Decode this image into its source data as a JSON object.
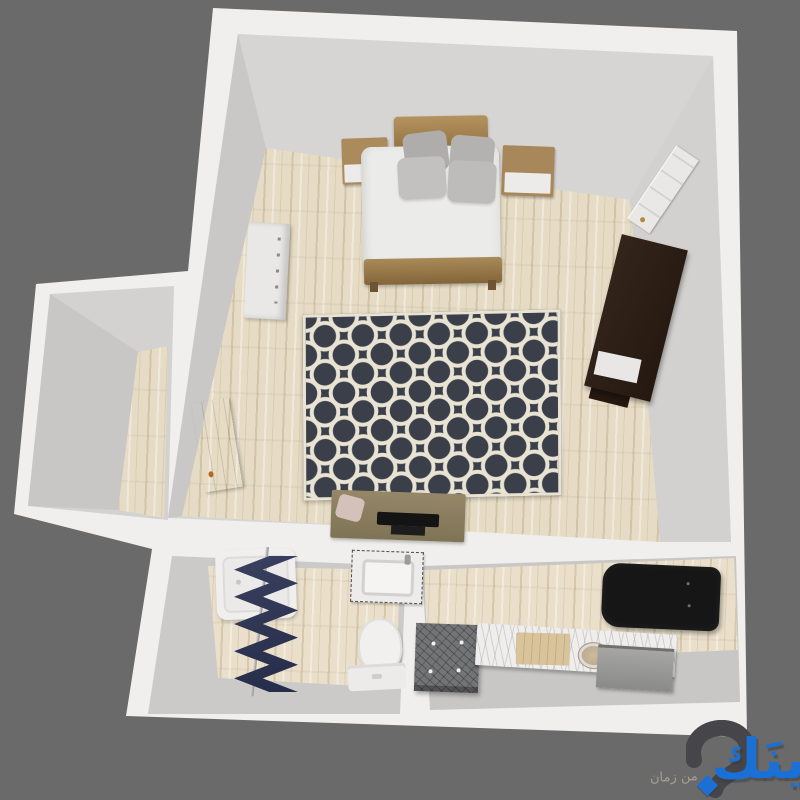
{
  "watermark": {
    "brand_text": "وينَك",
    "tagline_text": "من زمان",
    "brand_color": "#1b70d6",
    "icon": "question-swoosh-icon"
  },
  "palette": {
    "background": "#6a6a6a",
    "wall": "#f0efed",
    "wall_face_light": "#d6d5d3",
    "wall_face_dark": "#c9c8c6",
    "floor_wood": "#e6dcc5",
    "rug_base": "#3a3f49",
    "rug_pattern": "#e9e3d4",
    "curtain_navy": "#343b58",
    "bed_wood": "#a8885a",
    "wardrobe_brown": "#2b1d15",
    "sofa_black": "#161616",
    "marble": "#efeeec",
    "accent_blue": "#1b70d6"
  },
  "plan": {
    "view": "3d-top-down-floorplan",
    "rooms": [
      {
        "id": "bedroom",
        "furniture": [
          "double-bed",
          "pillows",
          "nightstand-left",
          "nightstand-right",
          "dresser-white",
          "wardrobe-dark",
          "door-open",
          "door-leaning",
          "area-rug-quatrefoil",
          "desk",
          "desk-chair",
          "monitor"
        ]
      },
      {
        "id": "closet",
        "furniture": []
      },
      {
        "id": "bathroom",
        "furniture": [
          "bathtub",
          "shower-rod",
          "shower-curtain-chevron",
          "vanity-sink",
          "toilet"
        ]
      },
      {
        "id": "kitchen",
        "furniture": [
          "sofa-black",
          "ottoman-tufted",
          "counter-marble",
          "cutting-board",
          "sink-round",
          "stove-appliance"
        ]
      }
    ]
  }
}
